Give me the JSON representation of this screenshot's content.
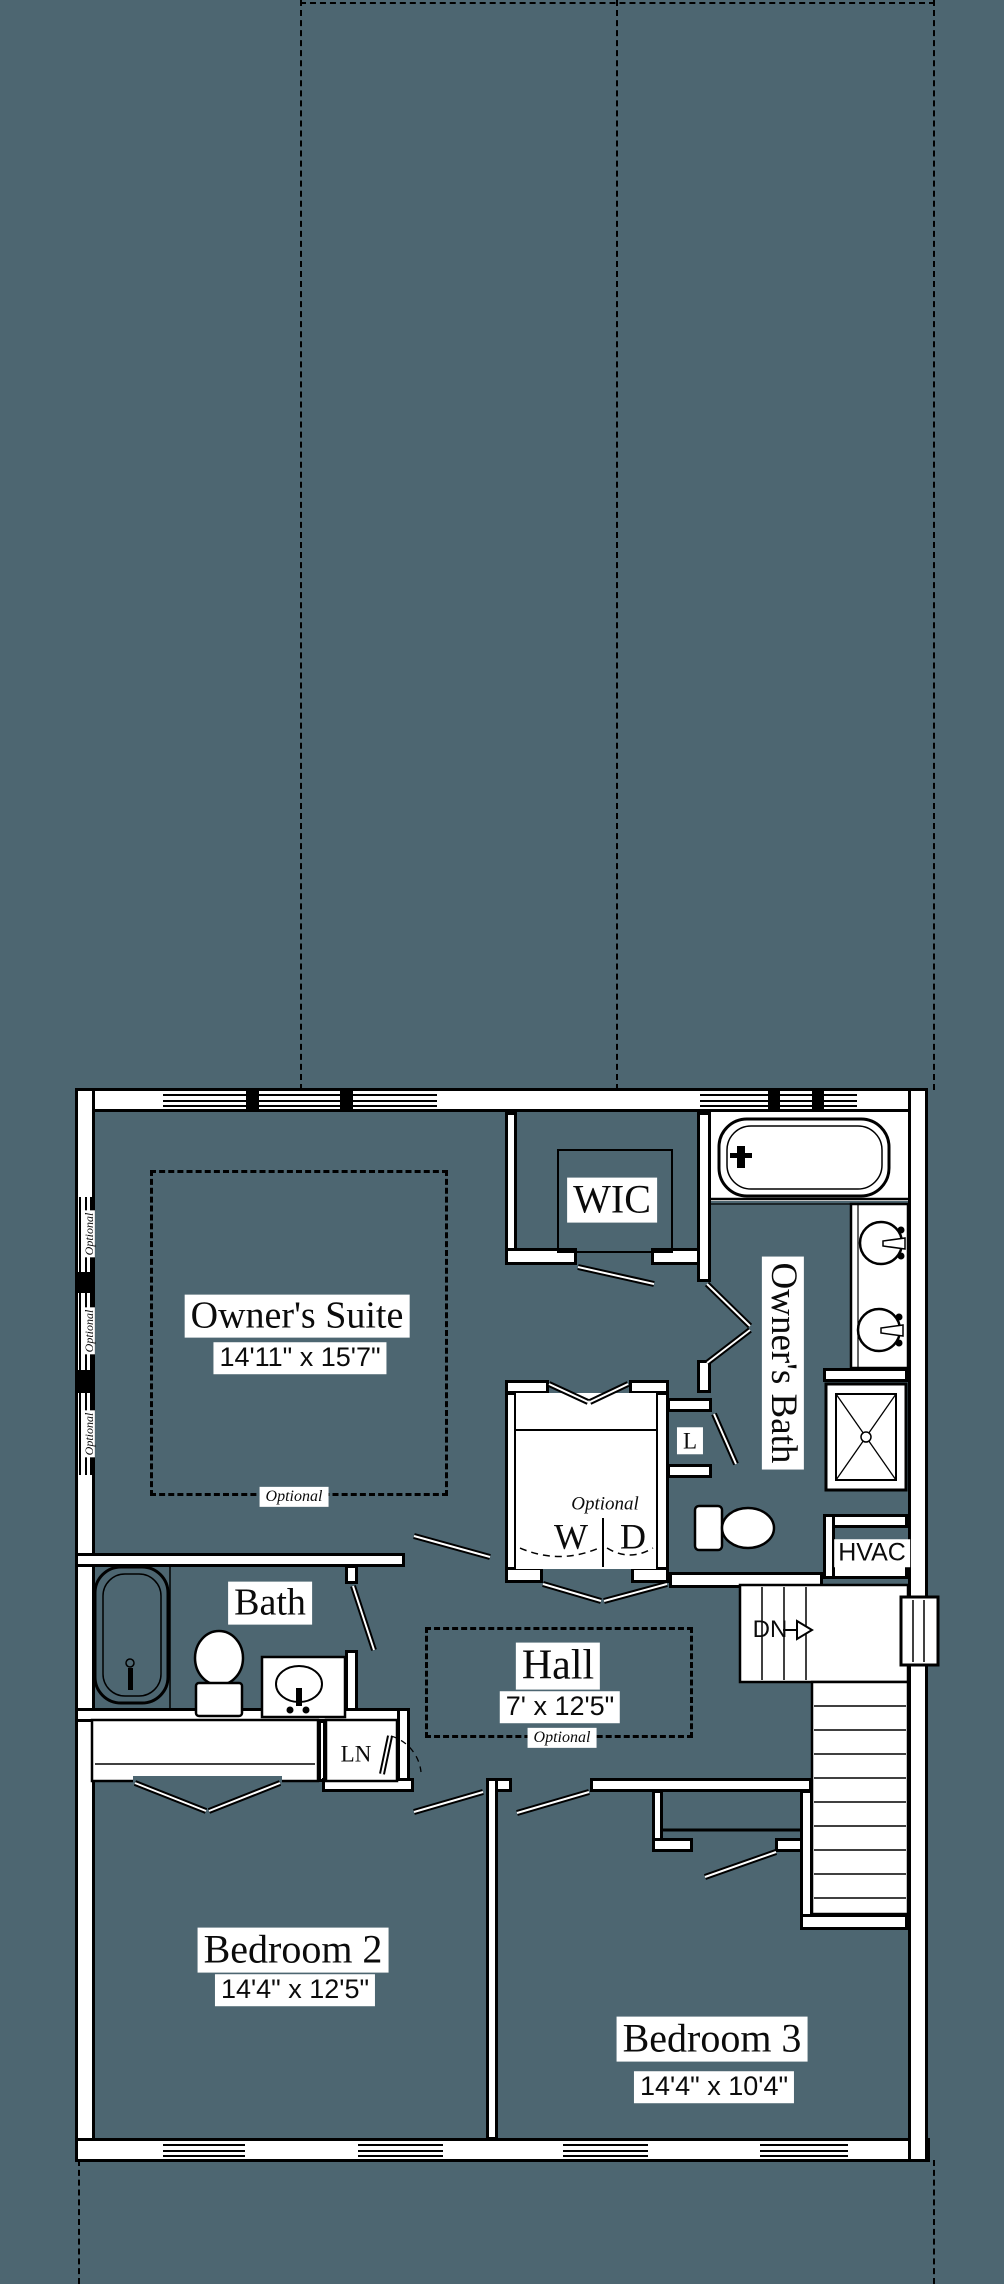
{
  "colors": {
    "background": "#4d6671",
    "lines": "#000000",
    "walls_fill": "#ffffff"
  },
  "rooms": {
    "owners_suite": {
      "name": "Owner's Suite",
      "dims": "14'11\" x 15'7\"",
      "optional_note": "Optional"
    },
    "wic": {
      "name": "WIC"
    },
    "owners_bath": {
      "name": "Owner's Bath"
    },
    "laundry_closet": {
      "optional_note": "Optional",
      "washer": "W",
      "dryer": "D"
    },
    "linen_closet": {
      "name": "L"
    },
    "hvac_closet": {
      "name": "HVAC"
    },
    "hall": {
      "name": "Hall",
      "dims": "7' x 12'5\"",
      "optional_note": "Optional"
    },
    "hall_bath": {
      "name": "Bath"
    },
    "hall_linen": {
      "name": "LN"
    },
    "stairs": {
      "down_label": "DN"
    },
    "bedroom_2": {
      "name": "Bedroom 2",
      "dims": "14'4\" x 12'5\""
    },
    "bedroom_3": {
      "name": "Bedroom 3",
      "dims": "14'4\" x 10'4\""
    }
  },
  "left_wall_windows": [
    {
      "label": "Optional"
    },
    {
      "label": "Optional"
    },
    {
      "label": "Optional"
    }
  ]
}
